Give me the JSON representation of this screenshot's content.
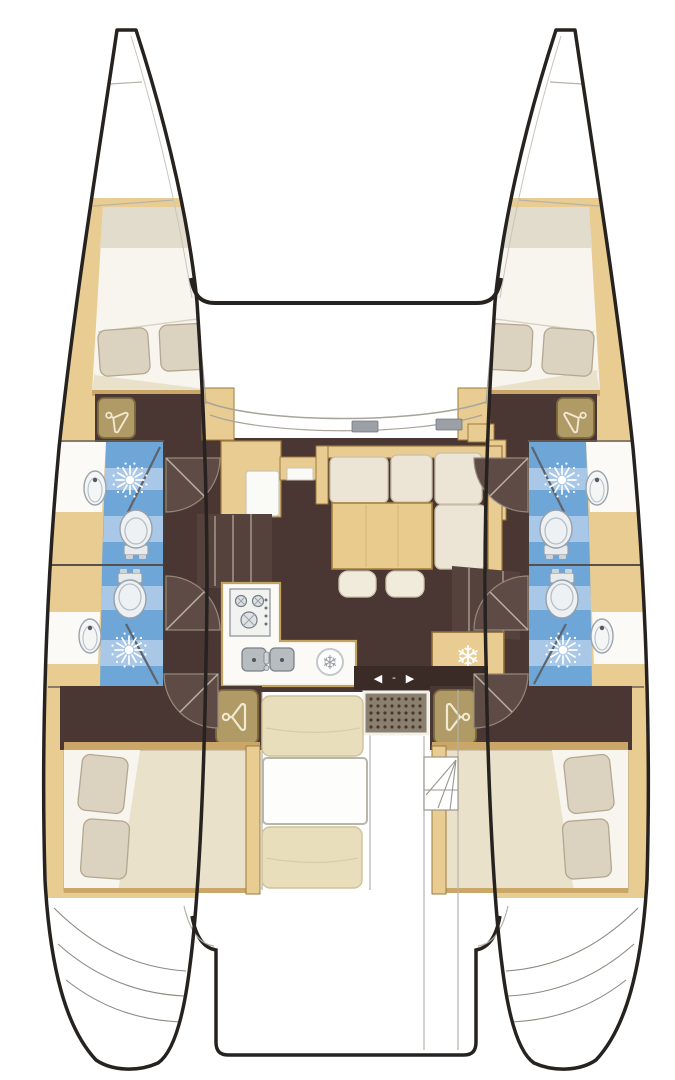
{
  "title": "Catamaran interior layout floor plan (top view)",
  "icons": {
    "snowflake": "❄",
    "arrow_left": "◀",
    "arrow_right": "▶",
    "arrow_separator": "-"
  },
  "colors": {
    "white": "#ffffff",
    "hull_outline": "#26221f",
    "deck_line": "#b7b3ab",
    "wood": "#e8cc92",
    "wood_border": "#9c7a3e",
    "floor": "#4a3733",
    "floor_light": "#5f4b46",
    "bulkhead": "#3a2b26",
    "bed_cream": "#eae1cb",
    "bed_white": "#f7f5ee",
    "bed_band": "#e2dccd",
    "pillow": "#dbd2bf",
    "pillow_border": "#b3a88f",
    "bath_blue": "#6ea6d8",
    "bath_blue_band": "#a9c8e8",
    "glass": "#5d646c",
    "fixture_white": "#eef1f3",
    "fixture_border": "#98a1a9",
    "steel": "#b7bcc1",
    "steel_dark": "#7a8187",
    "counter": "#fbfaf6",
    "cushion": "#ece4d4",
    "cushion_border": "#c9bfa9",
    "cockpit_cushion": "#e8debb",
    "cockpit_cushion_border": "#cec29a",
    "table_wood": "#e9cb8e",
    "table_border": "#a5823f",
    "stool": "#f1ebdb",
    "stairs": "#55423d",
    "stair_line": "#97897f",
    "grate": "#8b8070",
    "grate_dot": "#45392c",
    "wardrobe": "#b09b66",
    "wardrobe_border": "#7c693c",
    "hanger": "#f2e9d2",
    "snowflake_gray": "#9aa0a6",
    "arrow": "#ffffff"
  },
  "diagram_data": {
    "type": "boat-floor-plan",
    "vessel": "sailing catamaran, 4-cabin / 4-head charter layout",
    "port_hull": [
      "forward double cabin with V-berth and pillows",
      "forward head: shower, wash basin, toilet",
      "aft head: toilet, wash basin, shower",
      "forward wardrobe",
      "aft wardrobe",
      "aft double cabin with pillows"
    ],
    "starboard_hull": [
      "forward double cabin with V-berth and pillows",
      "forward head: shower, wash basin, toilet",
      "aft head: toilet, wash basin, shower",
      "forward wardrobe",
      "aft wardrobe",
      "aft double cabin with pillows"
    ],
    "bridgedeck": [
      "salon with L-shaped settee, wood table and two stools",
      "galley with 3-burner stove, double sink and fridge",
      "freezer cabinet",
      "forward console unit",
      "companionway stairs to port hull",
      "companionway stairs to starboard hull",
      "sliding door to cockpit"
    ],
    "cockpit": [
      "bench cushions",
      "cockpit table",
      "deck grate",
      "steps",
      "transom sugar-scoop steps on both hulls"
    ],
    "fixture_counts": {
      "double_beds": 4,
      "toilets": 4,
      "showers": 4,
      "wash_basins": 4,
      "wardrobes": 4,
      "stove_burners": 3,
      "galley_sinks": 2,
      "fridges": 1,
      "freezers": 1,
      "stools": 2
    }
  }
}
